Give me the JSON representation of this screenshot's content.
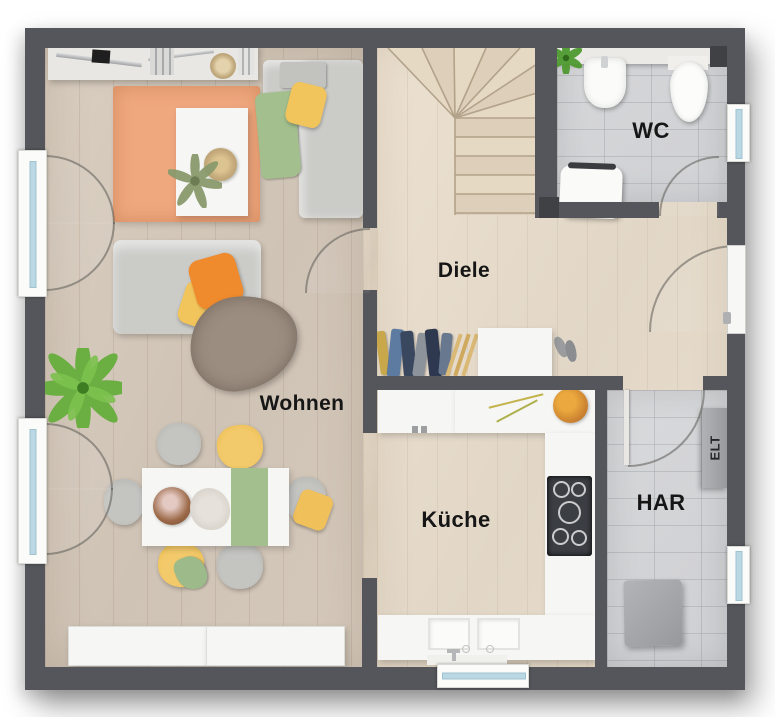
{
  "page": {
    "title": "Erdgeschoss Grundriss"
  },
  "rooms": [
    {
      "id": "wohnen",
      "label": "Wohnen"
    },
    {
      "id": "diele",
      "label": "Diele"
    },
    {
      "id": "wc",
      "label": "WC"
    },
    {
      "id": "kueche",
      "label": "Küche"
    },
    {
      "id": "har",
      "label": "HAR"
    },
    {
      "id": "elt",
      "label": "ELT"
    }
  ],
  "colors": {
    "wall": "#54565b",
    "wall_dark": "#3f4145",
    "floor_living": "#cfc3b5",
    "floor_hall": "#e4d9c9",
    "floor_tile": "#d2d3d5",
    "counter_white": "#f6f6f4",
    "rug_peach": "#efa77e",
    "sofa_gray": "#cbcbc8",
    "pillow_orange": "#ef8a2d",
    "pillow_yellow": "#f2c45c",
    "throw_green": "#a2bf8d",
    "blanket_taupe": "#9b8e81",
    "chair_yellow": "#f0c05a",
    "plant_green": "#66ae3c",
    "glass_blue": "#b9d8e3",
    "window_frame": "#fbfbfa",
    "cooktop_dark": "#3b3e43",
    "appliance_gray": "#a5a7aa",
    "label_text": "#161616"
  },
  "furniture_icons": [
    "wall-shelf-icon",
    "rug-icon",
    "coffee-table-icon",
    "corner-sofa-icon",
    "sofa-icon",
    "palm-plant-icon",
    "dining-table-icon",
    "dining-chair-icon",
    "tv-lowboard-icon",
    "coat-rack-icon",
    "shoe-cabinet-icon",
    "winder-stairs-icon",
    "wc-sink-icon",
    "wc-toilet-icon",
    "wc-cabinet-icon",
    "kitchen-counter-icon",
    "cooktop-icon",
    "kitchen-sink-icon",
    "fruit-bowl-icon",
    "washer-icon",
    "elt-cabinet-icon",
    "entrance-door-icon",
    "french-window-icon",
    "window-icon"
  ]
}
